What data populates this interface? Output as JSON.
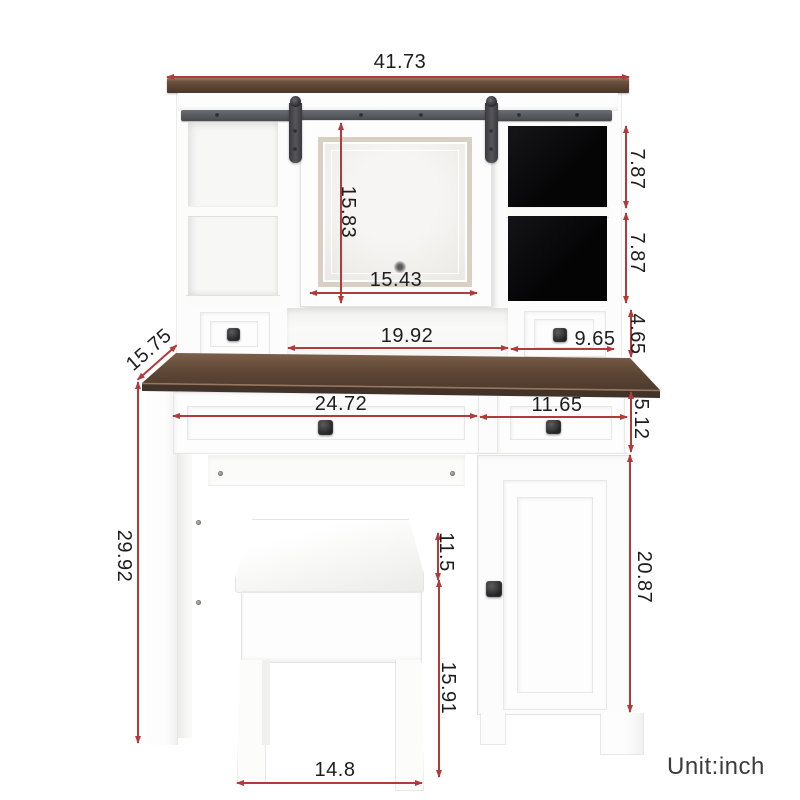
{
  "unit_label": "Unit:inch",
  "dimensions": {
    "hutch_width": "41.73",
    "cubby_top_height": "7.87",
    "cubby_bottom_height": "7.87",
    "mirror_height": "15.83",
    "mirror_width": "15.43",
    "hutch_mid_width": "19.92",
    "hutch_drawer_width": "9.65",
    "hutch_drawer_height": "4.65",
    "desk_depth": "15.75",
    "main_drawer_width": "24.72",
    "side_drawer_width": "11.65",
    "drawer_height": "5.12",
    "desk_height": "29.92",
    "cushion_height": "11.5",
    "stool_leg_height": "15.91",
    "stool_width": "14.8",
    "cabinet_height": "20.87"
  }
}
